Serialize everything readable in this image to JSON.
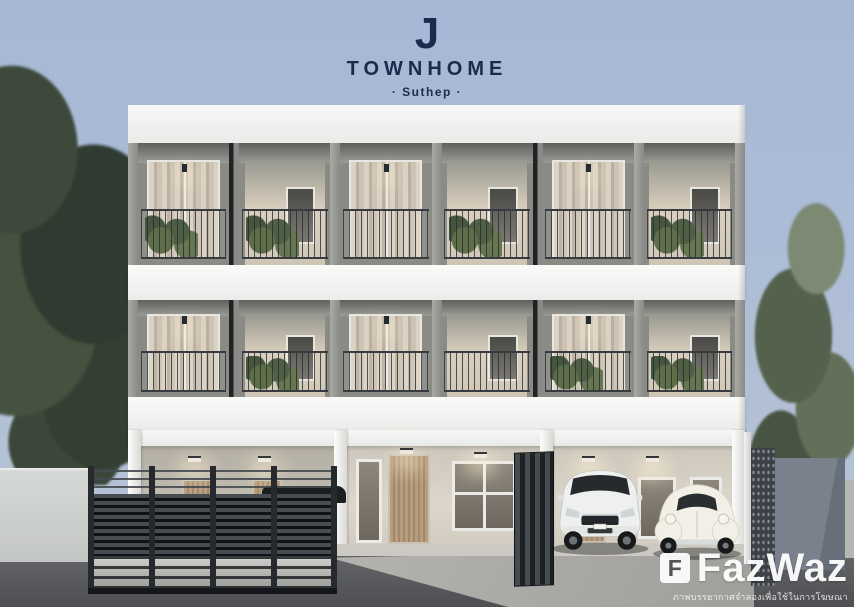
{
  "logo": {
    "mark": "J",
    "title": "TOWNHOME",
    "subtitle": "· Suthep ·"
  },
  "watermark": {
    "icon_letter": "F",
    "brand": "FazWaz",
    "disclaimer": "ภาพบรรยากาศจำลองเพื่อใช้ในการโฆษณา"
  },
  "colors": {
    "sky": "#aebdd6",
    "logo_navy": "#1e2a4c",
    "building_white": "#f3f3f1",
    "facade_gray": "#8a8b85",
    "ground_beige": "#d6cfc4",
    "wood_door": "#b79d80",
    "gate_dark": "#23272b",
    "road_asphalt": "#535457",
    "tree_green_dark": "#33402f",
    "tree_green_light": "#62705a",
    "watermark_white": "#ffffff"
  }
}
